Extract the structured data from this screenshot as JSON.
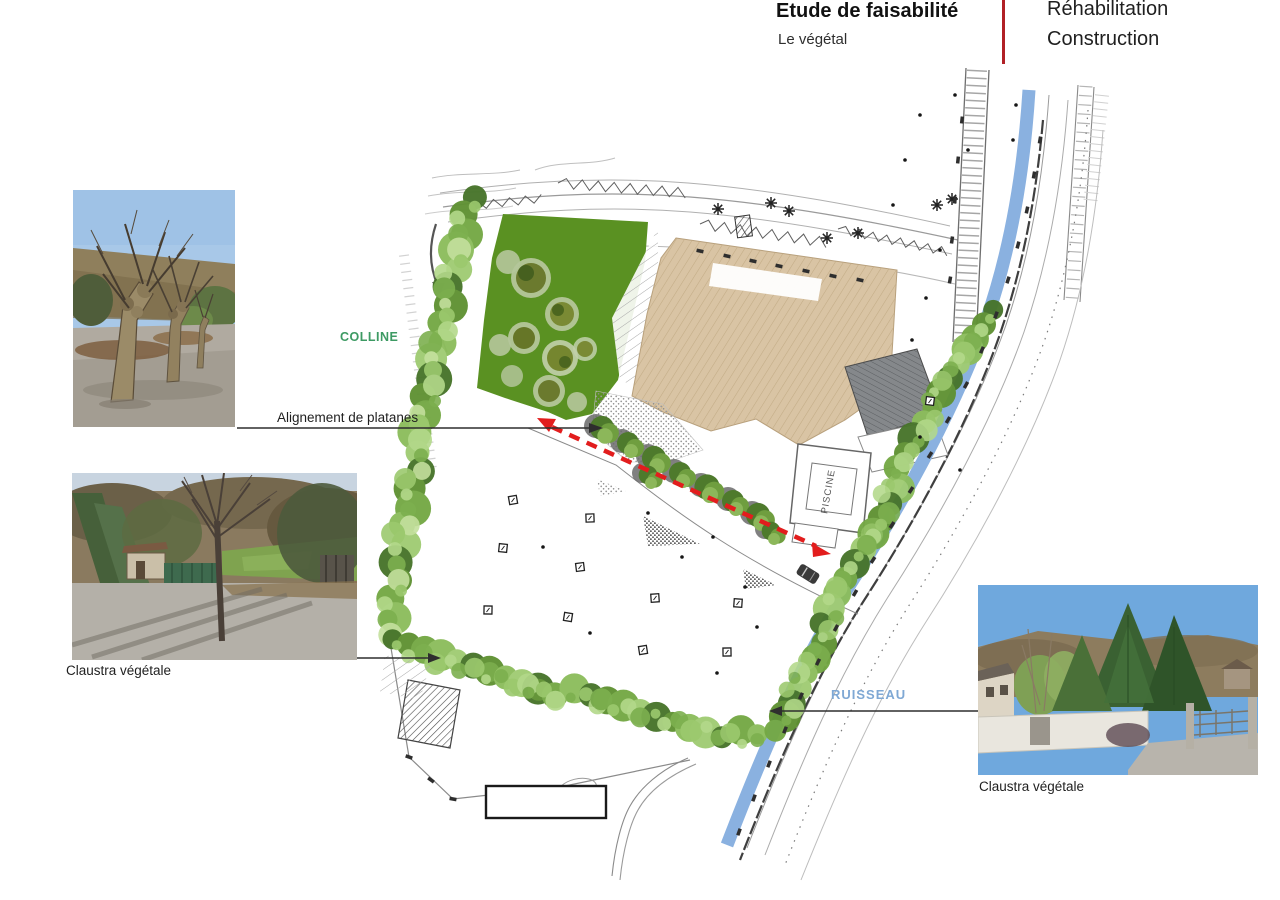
{
  "header": {
    "title": "Etude de faisabilité",
    "subtitle": "Le végétal",
    "right_top": "Réhabilitation",
    "right_bottom": "Construction",
    "divider_color": "#b12026"
  },
  "plan": {
    "labels": {
      "colline": "COLLINE",
      "ruisseau": "RUISSEAU",
      "piscine": "PISCINE"
    },
    "colors": {
      "grass": "#5a9122",
      "building_tan": "#d9c4a4",
      "building_gray": "#85888b",
      "stream": "#8ab1e0",
      "arrow_red": "#e21d1d",
      "colline_text": "#3d9a63",
      "ruisseau_text": "#7fa8d4"
    }
  },
  "annotations": {
    "platanes": {
      "label": "Alignement de platanes"
    },
    "claustra_left": {
      "label": "Claustra végétale"
    },
    "claustra_right": {
      "label": "Claustra végétale"
    }
  }
}
